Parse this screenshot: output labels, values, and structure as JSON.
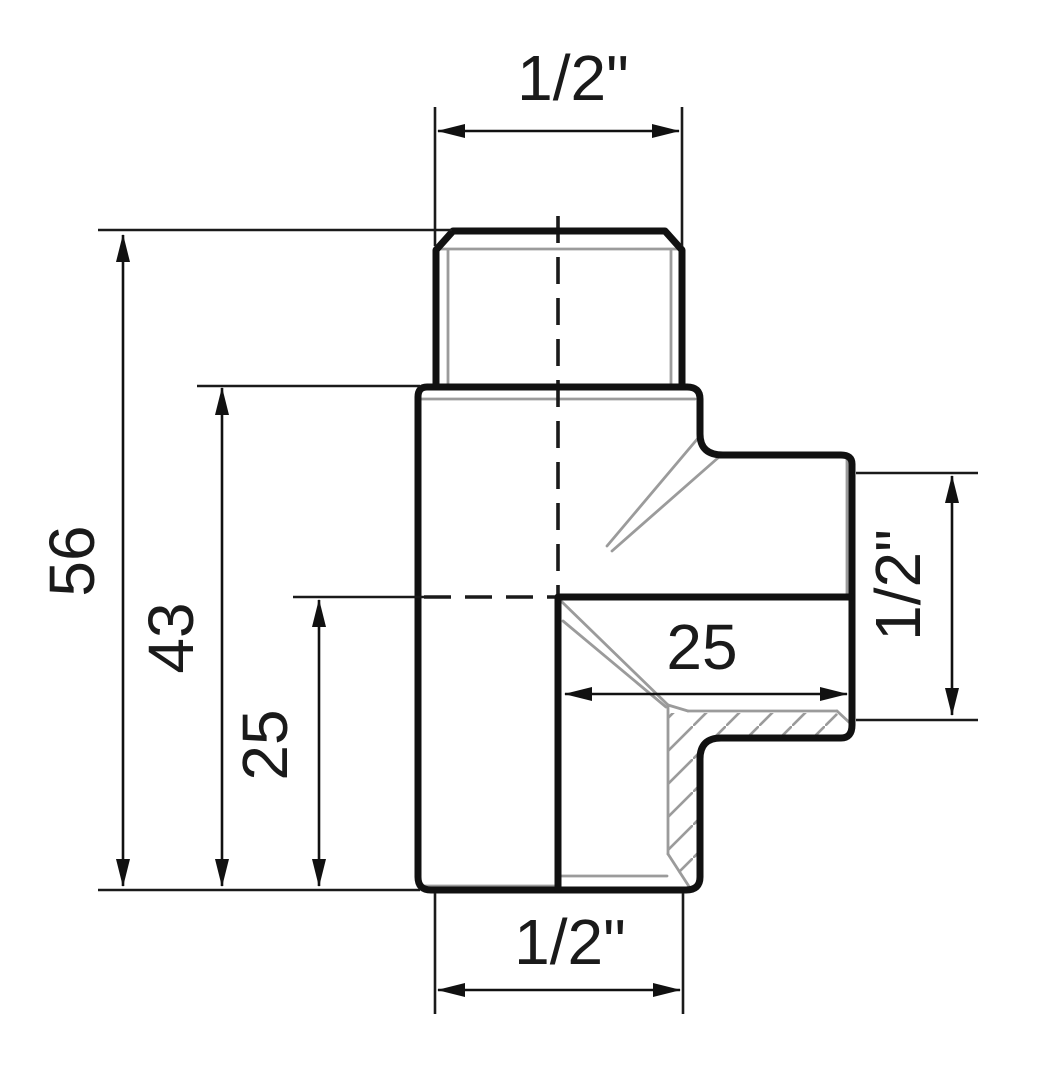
{
  "drawing": {
    "type": "technical-drawing",
    "subject": "threaded pipe tee fitting, half-section view",
    "colors": {
      "outline": "#111111",
      "thin_line": "#1a1a1a",
      "thread_gray": "#9b9b9b",
      "background": "#ffffff"
    },
    "dims": {
      "top_thread_size": "1/2\"",
      "overall_height": "56",
      "body_height": "43",
      "branch_center_height": "25",
      "branch_thread_depth": "25",
      "branch_thread_size": "1/2\"",
      "bottom_thread_size": "1/2\""
    }
  }
}
